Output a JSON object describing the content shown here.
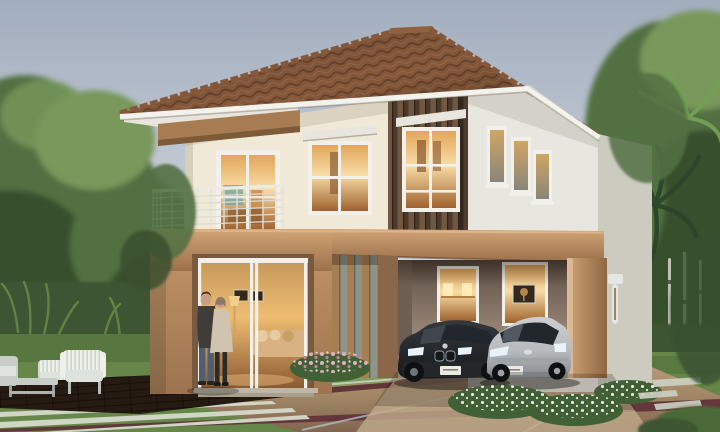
{
  "scene": {
    "subject": "two-story-house-exterior-rendering",
    "objects": [
      "sky",
      "trees-left",
      "trees-right",
      "palm-fronds",
      "birch-trunks",
      "hedge-left",
      "hedge-right",
      "hip-roof",
      "roof-fascia",
      "eave-soffit",
      "wood-eave-board",
      "upper-cream-wall",
      "balcony-railing",
      "balcony-window",
      "four-pane-window",
      "window-awning",
      "wood-slat-tower",
      "tower-window",
      "right-wing-wall",
      "small-window-1",
      "small-window-2",
      "small-window-3",
      "wall-lamp",
      "floor-band",
      "balcony-parapet",
      "carport-header",
      "living-room-volume",
      "living-room-doorway",
      "sofa",
      "wall-art",
      "floor-lamp",
      "entry-steps",
      "slat-screen",
      "carport",
      "carport-window-lamps",
      "carport-window-art",
      "carport-pillar",
      "sedan-car",
      "hatchback-car",
      "license-plates",
      "couple-man",
      "couple-woman",
      "outdoor-armchair",
      "outdoor-side-chair",
      "outdoor-sofa",
      "coffee-table",
      "wood-deck",
      "driveway",
      "maroon-border-strips",
      "expansion-joint-lines",
      "paver-stripes",
      "lawn",
      "pink-flower-bed",
      "white-flower-bed",
      "stepping-stones",
      "corner-shrubs"
    ]
  },
  "palette": {
    "sky_top": "#a2adbe",
    "sky_mid": "#cdd3da",
    "sky_horizon": "#eae8e3",
    "roof_dark": "#503626",
    "roof_mid": "#6d4833",
    "roof_light": "#86583a",
    "fascia_white": "#f3f2ec",
    "soffit": "#e7e5dd",
    "eave_wood": "#a87c52",
    "eave_wood_dark": "#7d5a38",
    "wall_cream": "#f0e9d7",
    "wall_cream_dark": "#ddd2bb",
    "wall_gray": "#e8e7df",
    "wall_gray_dark": "#cbcbc0",
    "band_tan_light": "#d2a577",
    "band_tan": "#bd9166",
    "band_tan_dark": "#996f4a",
    "volume_tan": "#bb8e63",
    "volume_tan_dark": "#9d7450",
    "slat_dark": "#4a392c",
    "slat_light": "#70573f",
    "screen_bg": "#8f9488",
    "screen_bar": "#a57e52",
    "frame_white": "#f1f0ea",
    "glow_light": "#f8dca6",
    "glow_mid": "#e2a65a",
    "glow_deep": "#a0622e",
    "carport_wall": "#968475",
    "carport_dark": "#5d4f45",
    "carport_floor": "#b7a287",
    "pillar_light": "#cfa478",
    "pillar_dark": "#8f6742",
    "lamp_white": "#e5e7e2",
    "grass_light": "#7f9e58",
    "grass_mid": "#67874a",
    "grass_dark": "#4c6939",
    "hedge_green": "#3d5430",
    "tree_light": "#79985c",
    "tree_mid": "#537042",
    "tree_dark": "#394f2e",
    "palm_dark": "#2c452a",
    "palm_light": "#74a055",
    "trunk_pale": "#d5d9cb",
    "drive_light": "#b79d7d",
    "drive_mid": "#a08665",
    "drive_dark": "#826550",
    "apron": "#c0ab8c",
    "maroon": "#5e3137",
    "joint_blue": "#b6c1c8",
    "curb_pale": "#c9cec1",
    "deck_dark": "#2c1f15",
    "deck_line": "#1a120c",
    "stripe_pale": "#d6dbcc",
    "car_dark": "#35393d",
    "car_darker": "#16181b",
    "car_glass": "#22272d",
    "car_silver": "#b8bbbe",
    "car_silver_dark": "#85898d",
    "headlight": "#e9f2f9",
    "plate_white": "#eceae2",
    "stone_pale": "#ced1c4",
    "flower_pink": "#dfb0bf",
    "flower_pink2": "#c28399",
    "flower_white": "#f3f5ef",
    "flower_green": "#426036",
    "skin": "#c89f83",
    "hair_dark": "#3b322c",
    "jacket_dark": "#403c39",
    "jeans_blue": "#4e5f72",
    "coat_beige": "#d0c3af",
    "leggings_dark": "#2d2b29",
    "furn_white": "#eef0ea",
    "furn_gray": "#c9cdc7",
    "cushion": "#dfe3dd",
    "sofa_tan": "#d8b282",
    "pillow": "#e9cc9e",
    "art_dark": "#32281e"
  }
}
